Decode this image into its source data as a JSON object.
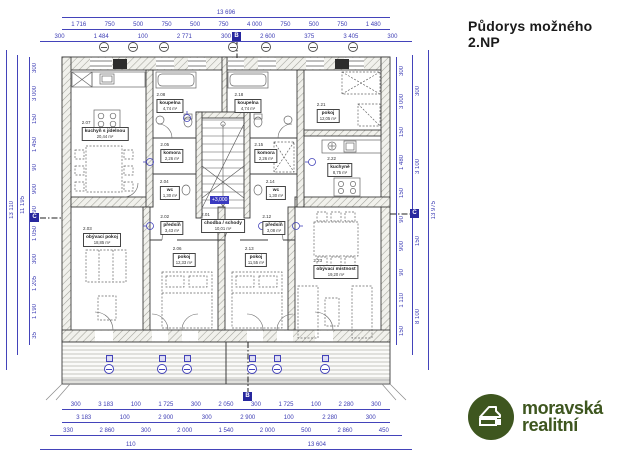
{
  "title": "Půdorys možného 2.NP",
  "level_marker": "+3,000",
  "section_markers": {
    "vertical": "B",
    "horizontal": "C"
  },
  "colors": {
    "dimension": "#3c3cb4",
    "wall_line": "#3c3c3c",
    "logo_green": "#3e561f"
  },
  "logo": {
    "line1": "moravská",
    "line2": "realitní",
    "reg": "®",
    "icon": "house-in-circle"
  },
  "rooms": [
    {
      "num": "2.07",
      "name": "kuchyň s jídelnou",
      "area": "20,44 m²"
    },
    {
      "num": "2.08",
      "name": "koupelna",
      "area": "4,74 m²"
    },
    {
      "num": "2.05",
      "name": "komora",
      "area": "2,26 m²"
    },
    {
      "num": "2.04",
      "name": "wc",
      "area": "1,30 m²"
    },
    {
      "num": "2.02",
      "name": "předsíň",
      "area": "3,43 m²"
    },
    {
      "num": "2.01",
      "name": "chodba / schody",
      "area": "10,01 m²"
    },
    {
      "num": "2.03",
      "name": "obývací pokoj",
      "area": "18,85 m²"
    },
    {
      "num": "2.06",
      "name": "pokoj",
      "area": "12,33 m²"
    },
    {
      "num": "2.18",
      "name": "koupelna",
      "area": "4,74 m²"
    },
    {
      "num": "2.15",
      "name": "komora",
      "area": "2,26 m²"
    },
    {
      "num": "2.14",
      "name": "wc",
      "area": "1,30 m²"
    },
    {
      "num": "2.12",
      "name": "předsíň",
      "area": "3,08 m²"
    },
    {
      "num": "2.13",
      "name": "pokoj",
      "area": "11,55 m²"
    },
    {
      "num": "2.21",
      "name": "pokoj",
      "area": "12,05 m²"
    },
    {
      "num": "2.22",
      "name": "kuchyně",
      "area": "8,75 m²"
    },
    {
      "num": "2.23",
      "name": "obývací místnost",
      "area": "19,20 m²"
    }
  ],
  "dims": {
    "top1": [
      "13 696"
    ],
    "top2": [
      "1 716",
      "750",
      "500",
      "750",
      "500",
      "750",
      "4 000",
      "750",
      "500",
      "750",
      "1 480"
    ],
    "top3": [
      "300",
      "1 484",
      "100",
      "2 771",
      "300",
      "2 600",
      "375",
      "3 405",
      "300"
    ],
    "bottom1": [
      "300",
      "3 183",
      "100",
      "1 725",
      "300",
      "2 050",
      "300",
      "1 725",
      "100",
      "2 280",
      "300"
    ],
    "bottom2": [
      "3 183",
      "100",
      "2 900",
      "300",
      "2 900",
      "100",
      "2 280",
      "300"
    ],
    "bottom3": [
      "330",
      "2 860",
      "300",
      "2 000",
      "1 540",
      "2 000",
      "500",
      "2 860",
      "450"
    ],
    "bottom4": [
      "110",
      "13 604"
    ],
    "left": [
      "300",
      "3 000",
      "150",
      "1 450",
      "90",
      "900",
      "90",
      "1 050",
      "300",
      "1 205",
      "1 190",
      "35"
    ],
    "left_inner": [
      "11 195"
    ],
    "left_total": [
      "13 110"
    ],
    "right": [
      "300",
      "3 000",
      "150",
      "1 480",
      "150",
      "90",
      "900",
      "90",
      "1 110",
      "150"
    ],
    "right_inner": [
      "300",
      "3 100",
      "150",
      "8 100"
    ],
    "right_total": [
      "13 975"
    ]
  }
}
